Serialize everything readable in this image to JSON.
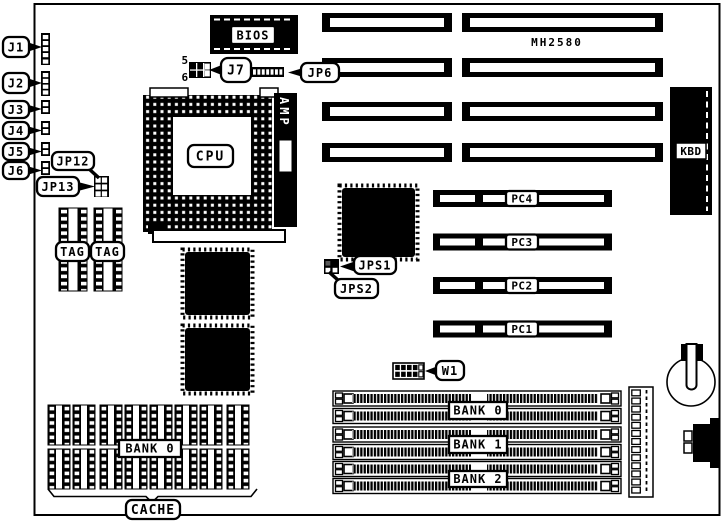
{
  "figure": {
    "board_model": "MH2580",
    "callouts": {
      "j1": "J1",
      "j2": "J2",
      "j3": "J3",
      "j4": "J4",
      "j5": "J5",
      "j6": "J6",
      "jp12": "JP12",
      "jp13": "JP13",
      "j7": "J7",
      "jp6": "JP6",
      "jps1": "JPS1",
      "jps2": "JPS2",
      "w1": "W1",
      "cache": "CACHE",
      "cpu": "CPU",
      "bios": "BIOS"
    },
    "j7_pin_numbers": {
      "top": "5",
      "bottom": "6"
    },
    "chip_labels": {
      "amp": "AMP",
      "kbd": "KBD"
    },
    "tag_sockets": [
      "TAG",
      "TAG"
    ],
    "pc_slots": [
      "PC4",
      "PC3",
      "PC2",
      "PC1"
    ],
    "simm_banks": [
      "BANK 0",
      "BANK 1",
      "BANK 2"
    ],
    "cache_bank": "BANK 0"
  }
}
